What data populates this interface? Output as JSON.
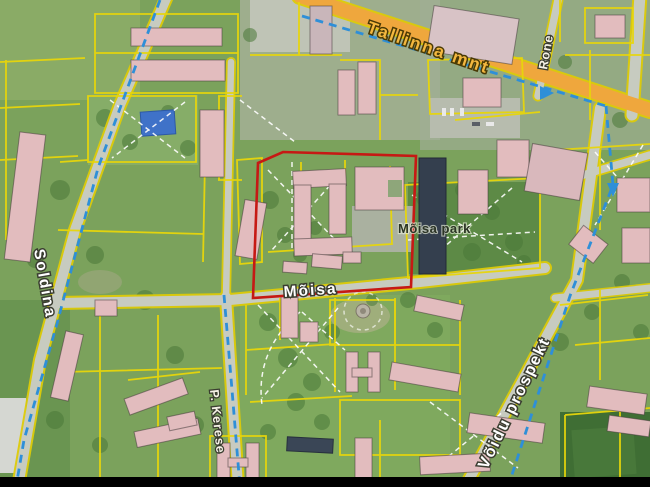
{
  "map": {
    "kind": "aerial cadastral map with selected site outlined in red",
    "streets": {
      "tallinna_mnt": "Tallinna mnt",
      "rone": "Rone",
      "soldina": "Soldina",
      "kerese": "P. Kerese",
      "moisa": "Mõisa",
      "voidu_prospekt": "Võidu prospekt"
    },
    "places": {
      "moisa_park": "Mõisa park"
    },
    "colors": {
      "parcel_line": "#e8d60a",
      "main_road": "#efa73d",
      "minor_road": "#c7cbc0",
      "selection_outline": "#c61914",
      "route_dashed": "#2e8fd8",
      "footpath_dashed": "#ffffff",
      "building": "#e2bcbe",
      "grass": "#7ba25c",
      "water": "#3f72c8",
      "frame_bar": "#000000"
    }
  }
}
